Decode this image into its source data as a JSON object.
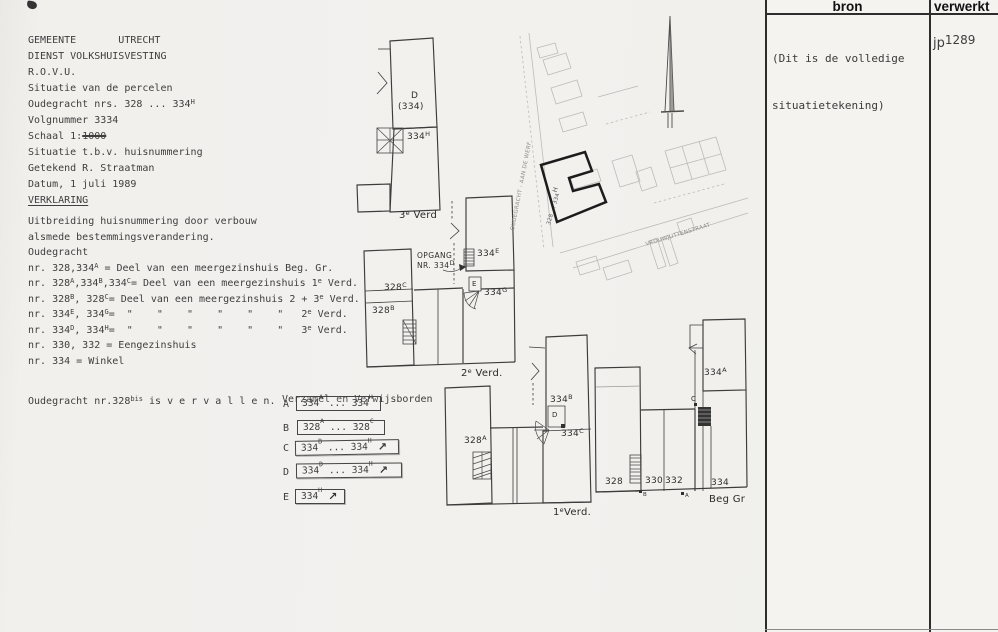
{
  "title_block": {
    "l1": "GEMEENTE       UTRECHT",
    "l2": "DIENST VOLKSHUISVESTING",
    "l3": "R.O.V.U.",
    "l4": "Situatie van de percelen",
    "l5": [
      "Oudegracht nrs. 328 ... 334",
      {
        "sup": "H"
      }
    ],
    "l6": "Volgnummer 3334",
    "l7": [
      "Schaal 1:",
      {
        "s": "1000"
      }
    ],
    "l8": "Situatie t.b.v. huisnummering",
    "l9": "Getekend R. Straatman",
    "l10": "Datum, 1 juli 1989",
    "l11": "VERKLARING"
  },
  "verklaring": {
    "lines": [
      [
        "Uitbreiding huisnummering door verbouw"
      ],
      [
        "alsmede bestemmingsverandering."
      ],
      [
        "Oudegracht"
      ],
      [
        "nr. 328,334",
        {
          "sup": "A"
        },
        " = Deel van een meergezinshuis Beg. Gr."
      ],
      [
        "nr. 328",
        {
          "sup": "A"
        },
        ",334",
        {
          "sup": "B"
        },
        ",334",
        {
          "sup": "C"
        },
        "= Deel van een meergezinshuis 1",
        {
          "sup": "e"
        },
        " Verd."
      ],
      [
        "nr. 328",
        {
          "sup": "B"
        },
        ", 328",
        {
          "sup": "C"
        },
        "= Deel van een meergezinshuis 2 + 3",
        {
          "sup": "e"
        },
        " Verd."
      ],
      [
        "nr. 334",
        {
          "sup": "E"
        },
        ", 334",
        {
          "sup": "G"
        },
        "=  \"    \"    \"    \"    \"    \"   2",
        {
          "sup": "e"
        },
        " Verd."
      ],
      [
        "nr. 334",
        {
          "sup": "D"
        },
        ", 334",
        {
          "sup": "H"
        },
        "=  \"    \"    \"    \"    \"    \"   3",
        {
          "sup": "e"
        },
        " Verd."
      ],
      [
        "nr. 330, 332 = Eengezinshuis"
      ],
      [
        "nr. 334 = Winkel"
      ]
    ]
  },
  "vervallen": [
    "Oudegracht nr.328",
    {
      "sup": "bis"
    },
    " is v e r v a l l e n."
  ],
  "legend": {
    "title": "Verzamel en Verwijsborden",
    "arrow_icon": "↗",
    "items": [
      {
        "key": "A",
        "text": [
          "334",
          {
            "sup": "A"
          },
          " ... 334",
          {
            "sup": "H"
          }
        ]
      },
      {
        "key": "B",
        "text": [
          "328",
          {
            "sup": "A"
          },
          " ... 328",
          {
            "sup": "C"
          }
        ]
      },
      {
        "key": "C",
        "text": [
          "334",
          {
            "sup": "B"
          },
          " ... 334",
          {
            "sup": "H"
          }
        ]
      },
      {
        "key": "D",
        "text": [
          "334",
          {
            "sup": "D"
          },
          " ... 334",
          {
            "sup": "H"
          }
        ]
      },
      {
        "key": "E",
        "text": [
          "334",
          {
            "sup": "H"
          }
        ]
      }
    ]
  },
  "plans": {
    "third_floor": {
      "unit_d": "D",
      "unit_d_num": "(334)",
      "unit_h": [
        "334",
        {
          "sup": "H"
        }
      ],
      "floor_label": [
        "3",
        {
          "sup": "e"
        },
        " Verd"
      ]
    },
    "second_floor": {
      "unit_328c": [
        "328",
        {
          "sup": "C"
        }
      ],
      "unit_328b": [
        "328",
        {
          "sup": "B"
        }
      ],
      "opgang_l1": "OPGANG",
      "opgang_l2": [
        "NR. 334",
        {
          "sup": "D"
        }
      ],
      "unit_334e": [
        "334",
        {
          "sup": "E"
        }
      ],
      "entrance_e": "E",
      "unit_334g": [
        "334",
        {
          "sup": "G"
        }
      ],
      "floor_label": [
        "2",
        {
          "sup": "e"
        },
        " Verd."
      ]
    },
    "first_floor": {
      "unit_328a": [
        "328",
        {
          "sup": "A"
        }
      ],
      "unit_334b": [
        "334",
        {
          "sup": "B"
        }
      ],
      "entrance_d": "D",
      "unit_334c": [
        "334",
        {
          "sup": "C"
        }
      ],
      "floor_label": [
        "1",
        {
          "sup": "e"
        },
        "Verd."
      ]
    },
    "ground_floor": {
      "n328": "328",
      "n330": "330",
      "n332": "332",
      "n334": "334",
      "unit_334a": [
        "334",
        {
          "sup": "A"
        }
      ],
      "entrance_c": "C",
      "mark_b": "B",
      "mark_a": "A",
      "floor_label": "Beg Gr"
    }
  },
  "site_map": {
    "street_1": "OUDEGRACHT - AAN DE WERF",
    "parcel_range": [
      "328 ... 334",
      {
        "sup": "H"
      }
    ],
    "street_2": "VROUWJUTTENSTRAAT"
  },
  "log_table": {
    "headers": [
      "bron",
      "verwerkt"
    ],
    "bron_note_l1": "(Dit is de volledige",
    "bron_note_l2": "situatietekening)",
    "verwerkt_value": [
      "jp",
      {
        "raise": "1289"
      }
    ]
  }
}
